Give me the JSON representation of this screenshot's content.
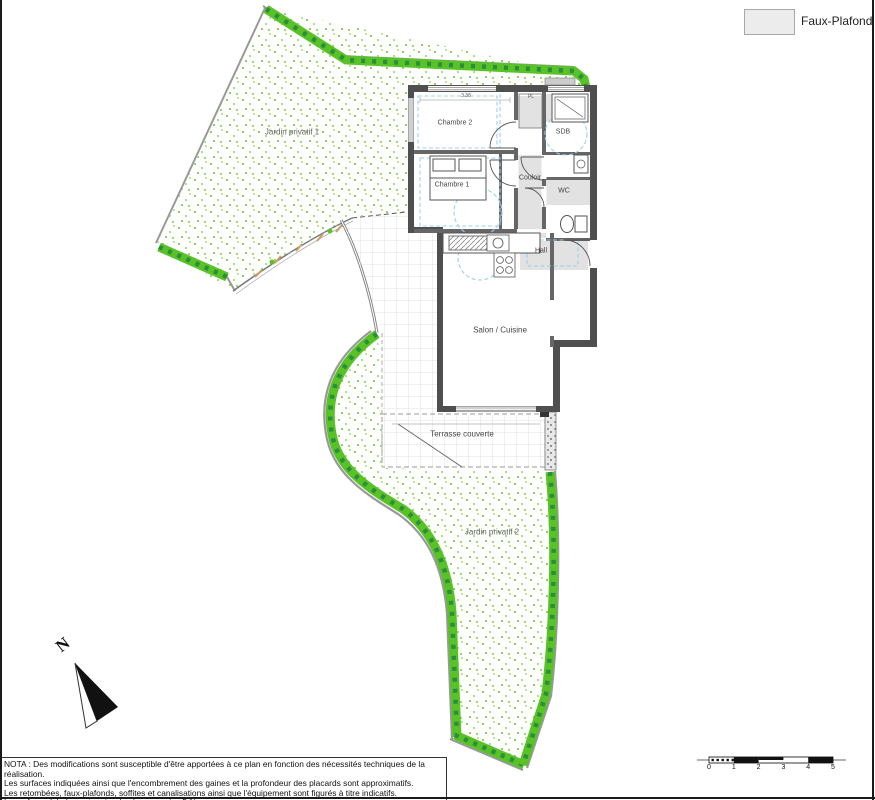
{
  "legend": {
    "label": "Faux-Plafond"
  },
  "plan": {
    "rooms": [
      {
        "id": "chambre2",
        "label": "Chambre 2"
      },
      {
        "id": "chambre1",
        "label": "Chambre 1"
      },
      {
        "id": "sdb",
        "label": "SDB"
      },
      {
        "id": "couloir",
        "label": "Couloir"
      },
      {
        "id": "wc",
        "label": "WC"
      },
      {
        "id": "hall",
        "label": "Hall"
      },
      {
        "id": "salon",
        "label": "Salon / Cuisine"
      },
      {
        "id": "terrasse",
        "label": "Terrasse couverte"
      }
    ],
    "gardens": [
      {
        "label": "Jardin privatif 1"
      },
      {
        "label": "Jardin privatif 2"
      }
    ],
    "annotations": {
      "placard": "PL",
      "dim_top": "3.38"
    },
    "north_label": "N"
  },
  "notes": {
    "lines": [
      "NOTA : Des modifications sont susceptible d'être apportées à ce plan en fonction des nécessités techniques de la réalisation.",
      "Les surfaces indiquées ainsi que l'encombrement des gaines et la profondeur des placards sont approximatifs.",
      "Les retombées, faux-plafonds, soffites et canalisations ainsi que l'équipement sont figurés à titre indicatifs.",
      "La surface globale peut varier de plus ou moins 5 %."
    ]
  },
  "scale_bar": {
    "ticks": [
      "0",
      "1",
      "2",
      "3",
      "4",
      "5"
    ]
  },
  "colors": {
    "hedge_green": "#58c226",
    "hedge_dark_green": "#2a8e3c",
    "speckle_green": "#8fd35f",
    "wall_gray": "#4f4f4f",
    "faux_plafond_gray": "#e2e2e2",
    "dashed_blue": "#9fd0e8"
  }
}
